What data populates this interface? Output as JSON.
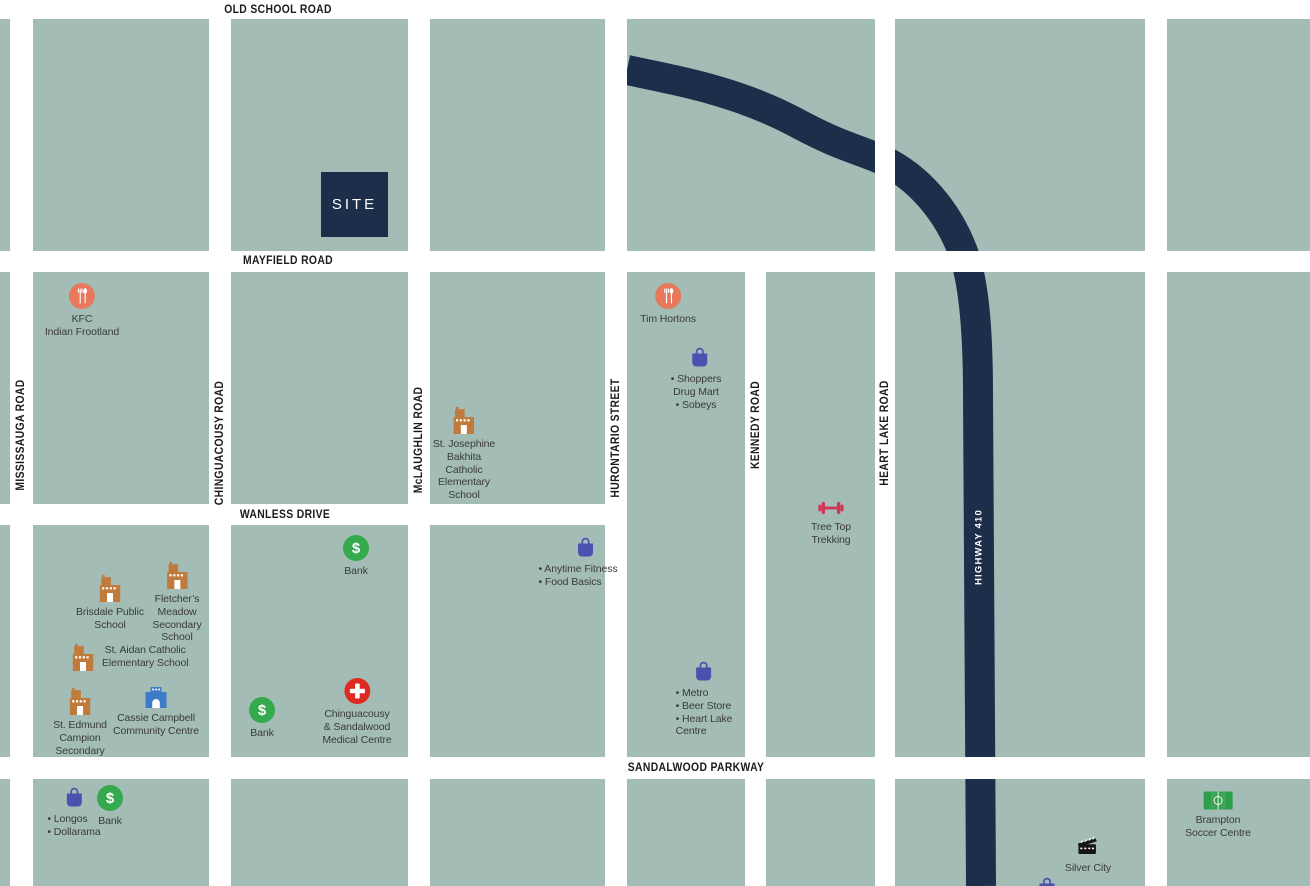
{
  "roads": {
    "horizontal": [
      {
        "name": "old-school-road",
        "label": "OLD SCHOOL ROAD"
      },
      {
        "name": "mayfield-road",
        "label": "MAYFIELD ROAD"
      },
      {
        "name": "wanless-drive",
        "label": "WANLESS DRIVE"
      },
      {
        "name": "sandalwood-parkway",
        "label": "SANDALWOOD PARKWAY"
      }
    ],
    "vertical": [
      {
        "name": "mississauga-road",
        "label": "MISSISSAUGA ROAD"
      },
      {
        "name": "chinguacousy-road",
        "label": "CHINGUACOUSY ROAD"
      },
      {
        "name": "mclaughlin-road",
        "label": "McLAUGHLIN ROAD"
      },
      {
        "name": "hurontario-street",
        "label": "HURONTARIO STREET"
      },
      {
        "name": "kennedy-road",
        "label": "KENNEDY ROAD"
      },
      {
        "name": "heart-lake-road",
        "label": "HEART LAKE ROAD"
      }
    ],
    "highway": {
      "name": "highway-410",
      "label": "HIGHWAY 410"
    }
  },
  "site": {
    "label": "SITE"
  },
  "pois": [
    {
      "name": "kfc-indian-frootland",
      "icon": "restaurant",
      "label": "KFC\nIndian Frootland"
    },
    {
      "name": "tim-hortons",
      "icon": "restaurant",
      "label": "Tim Hortons"
    },
    {
      "name": "shoppers-drug-mart-sobeys",
      "icon": "shopping-bag",
      "label": "• Shoppers\nDrug Mart\n• Sobeys"
    },
    {
      "name": "st-josephine-bakhita-school",
      "icon": "school",
      "label": "St. Josephine\nBakhita\nCatholic\nElementary\nSchool"
    },
    {
      "name": "anytime-fitness-food-basics",
      "icon": "shopping-bag",
      "label": "• Anytime Fitness\n• Food Basics"
    },
    {
      "name": "metro-beer-store-heart-lake-centre",
      "icon": "shopping-bag",
      "label": "• Metro\n• Beer Store\n• Heart Lake\nCentre"
    },
    {
      "name": "tree-top-trekking",
      "icon": "dumbbell",
      "label": "Tree Top\nTrekking"
    },
    {
      "name": "brisdale-public-school",
      "icon": "school",
      "label": "Brisdale Public\nSchool"
    },
    {
      "name": "fletchers-meadow-secondary",
      "icon": "school",
      "label": "Fletcher’s\nMeadow\nSecondary\nSchool"
    },
    {
      "name": "st-aidan-catholic-elementary",
      "icon": "school",
      "label": "St. Aidan Catholic\nElementary School"
    },
    {
      "name": "st-edmund-campion-secondary",
      "icon": "school",
      "label": "St. Edmund\nCampion\nSecondary"
    },
    {
      "name": "cassie-campbell-community-centre",
      "icon": "community-centre",
      "label": "Cassie Campbell\nCommunity Centre"
    },
    {
      "name": "bank-wanless-north",
      "icon": "bank",
      "label": "Bank"
    },
    {
      "name": "bank-wanless-south",
      "icon": "bank",
      "label": "Bank"
    },
    {
      "name": "chinguacousy-sandalwood-medical-centre",
      "icon": "medical",
      "label": "Chinguacousy\n& Sandalwood\nMedical Centre"
    },
    {
      "name": "longos-dollarama",
      "icon": "shopping-bag",
      "label": "• Longos\n• Dollarama"
    },
    {
      "name": "bank-sandalwood",
      "icon": "bank",
      "label": "Bank"
    },
    {
      "name": "silver-city",
      "icon": "clapperboard",
      "label": "Silver City"
    },
    {
      "name": "brampton-soccer-centre",
      "icon": "soccer-field",
      "label": "Brampton\nSoccer Centre"
    },
    {
      "name": "shopping-plaza-partial",
      "icon": "shopping-bag",
      "label": ""
    }
  ],
  "colors": {
    "block": "#A3BDB6",
    "road": "#FFFFFF",
    "navy": "#1C2E4A",
    "restaurant": "#E8795C",
    "shopping_bag": "#4C51AF",
    "school": "#C07A3C",
    "bank": "#35A94D",
    "medical": "#DE2A23",
    "fitness": "#D23557",
    "community_centre": "#3D7CC9",
    "soccer": "#2F9E4B",
    "cinema": "#151515"
  }
}
